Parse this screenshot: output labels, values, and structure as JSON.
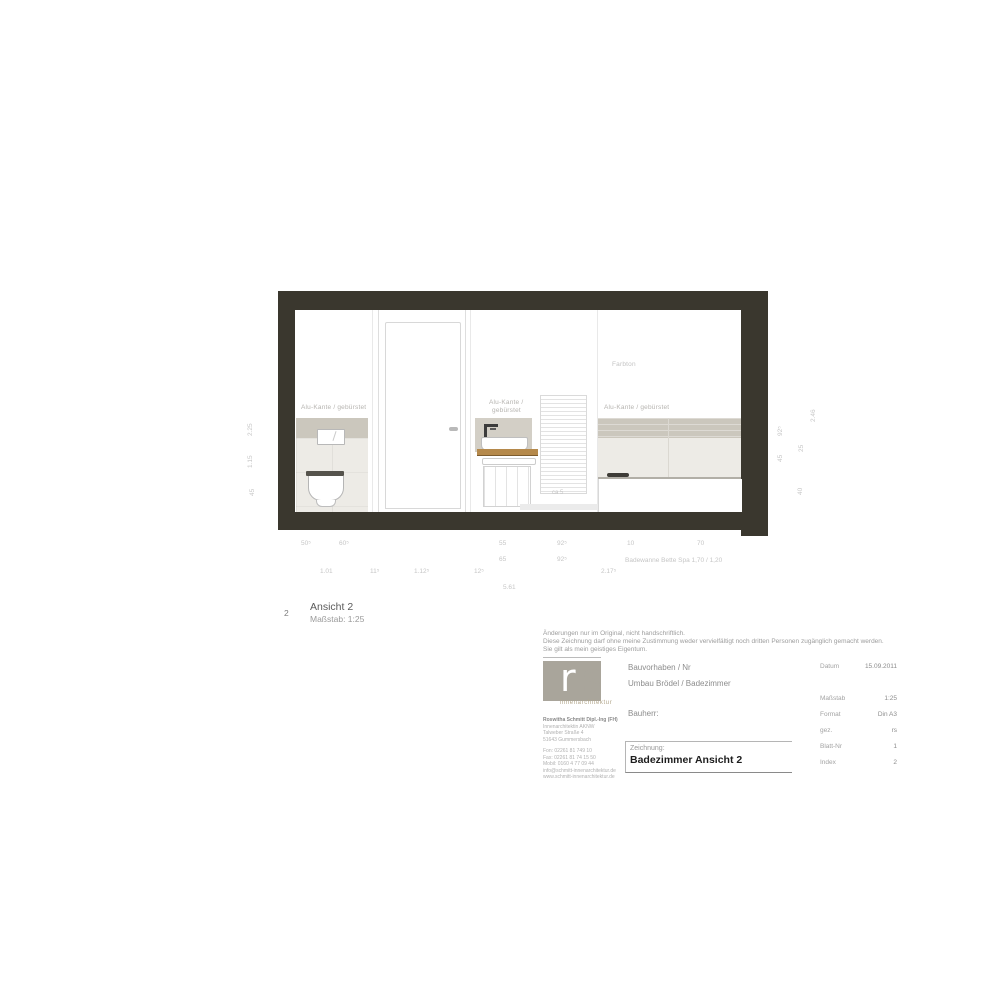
{
  "drawing": {
    "labels": {
      "alu_left": "Alu-Kante / gebürstet",
      "alu_sink_line1": "Alu-Kante /",
      "alu_sink_line2": "gebürstet",
      "alu_right": "Alu-Kante / gebürstet",
      "farbton": "Farbton",
      "radiator_note": "ca 5"
    }
  },
  "dims": {
    "row1": [
      "50⁵",
      "60⁵",
      "55",
      "92⁵",
      "10",
      "70"
    ],
    "row2": [
      "65",
      "92⁵"
    ],
    "row2_note": "Badewanne Bette Spa 1,70 / 1,20",
    "row3": [
      "1.01",
      "11⁵",
      "1.12⁵",
      "12⁵",
      "2.17⁵"
    ],
    "total": "5.61",
    "left_vertical": [
      "2.25",
      "1.15",
      "45"
    ],
    "right_vertical": [
      "92⁵",
      "45",
      "25",
      "40",
      "2.46"
    ]
  },
  "view_title": {
    "number": "2",
    "name": "Ansicht 2",
    "scale": "Maßstab: 1:25"
  },
  "disclaimer": {
    "line1": "Änderungen nur im Original, nicht handschriftlich.",
    "line2": "Diese Zeichnung darf ohne meine Zustimmung weder vervielfältigt noch dritten Personen zugänglich gemacht werden.",
    "line3": "Sie gilt als mein geistiges Eigentum."
  },
  "titleblock": {
    "logo": {
      "text_r": "r",
      "text_s": "s",
      "subtitle": "innenarchitektur"
    },
    "address": {
      "name": "Roswitha Schmitt Dipl.-Ing (FH)",
      "line2": "Innenarchitektin AKNW",
      "line3": "Talweber Straße 4",
      "line4": "51643 Gummersbach",
      "fon": "Fon:   02261 81 749 10",
      "fax": "Fax:   02261 81 74 15 50",
      "mobil": "Mobil: 0160 4 77 09 44",
      "email": "info@schmitt-innenarchitektur.de",
      "web": "www.schmitt-innenarchitektur.de"
    },
    "project_label": "Bauvorhaben / Nr",
    "project_value": "Umbau Brödel / Badezimmer",
    "client_label": "Bauherr:",
    "drawing_label": "Zeichnung:",
    "drawing_value": "Badezimmer Ansicht 2",
    "meta": [
      {
        "label": "Datum",
        "value": "15.09.2011"
      },
      {
        "label": "Maßstab",
        "value": "1:25"
      },
      {
        "label": "Format",
        "value": "Din A3"
      },
      {
        "label": "gez.",
        "value": "rs"
      },
      {
        "label": "Blatt-Nr",
        "value": "1"
      },
      {
        "label": "Index",
        "value": "2"
      }
    ]
  },
  "colors": {
    "wall_section": "#3a372e",
    "tile_band": "#cbc7bd",
    "tile_light": "#edebe6",
    "counter_wood": "#b5894b",
    "logo_grey": "#a9a59b"
  }
}
